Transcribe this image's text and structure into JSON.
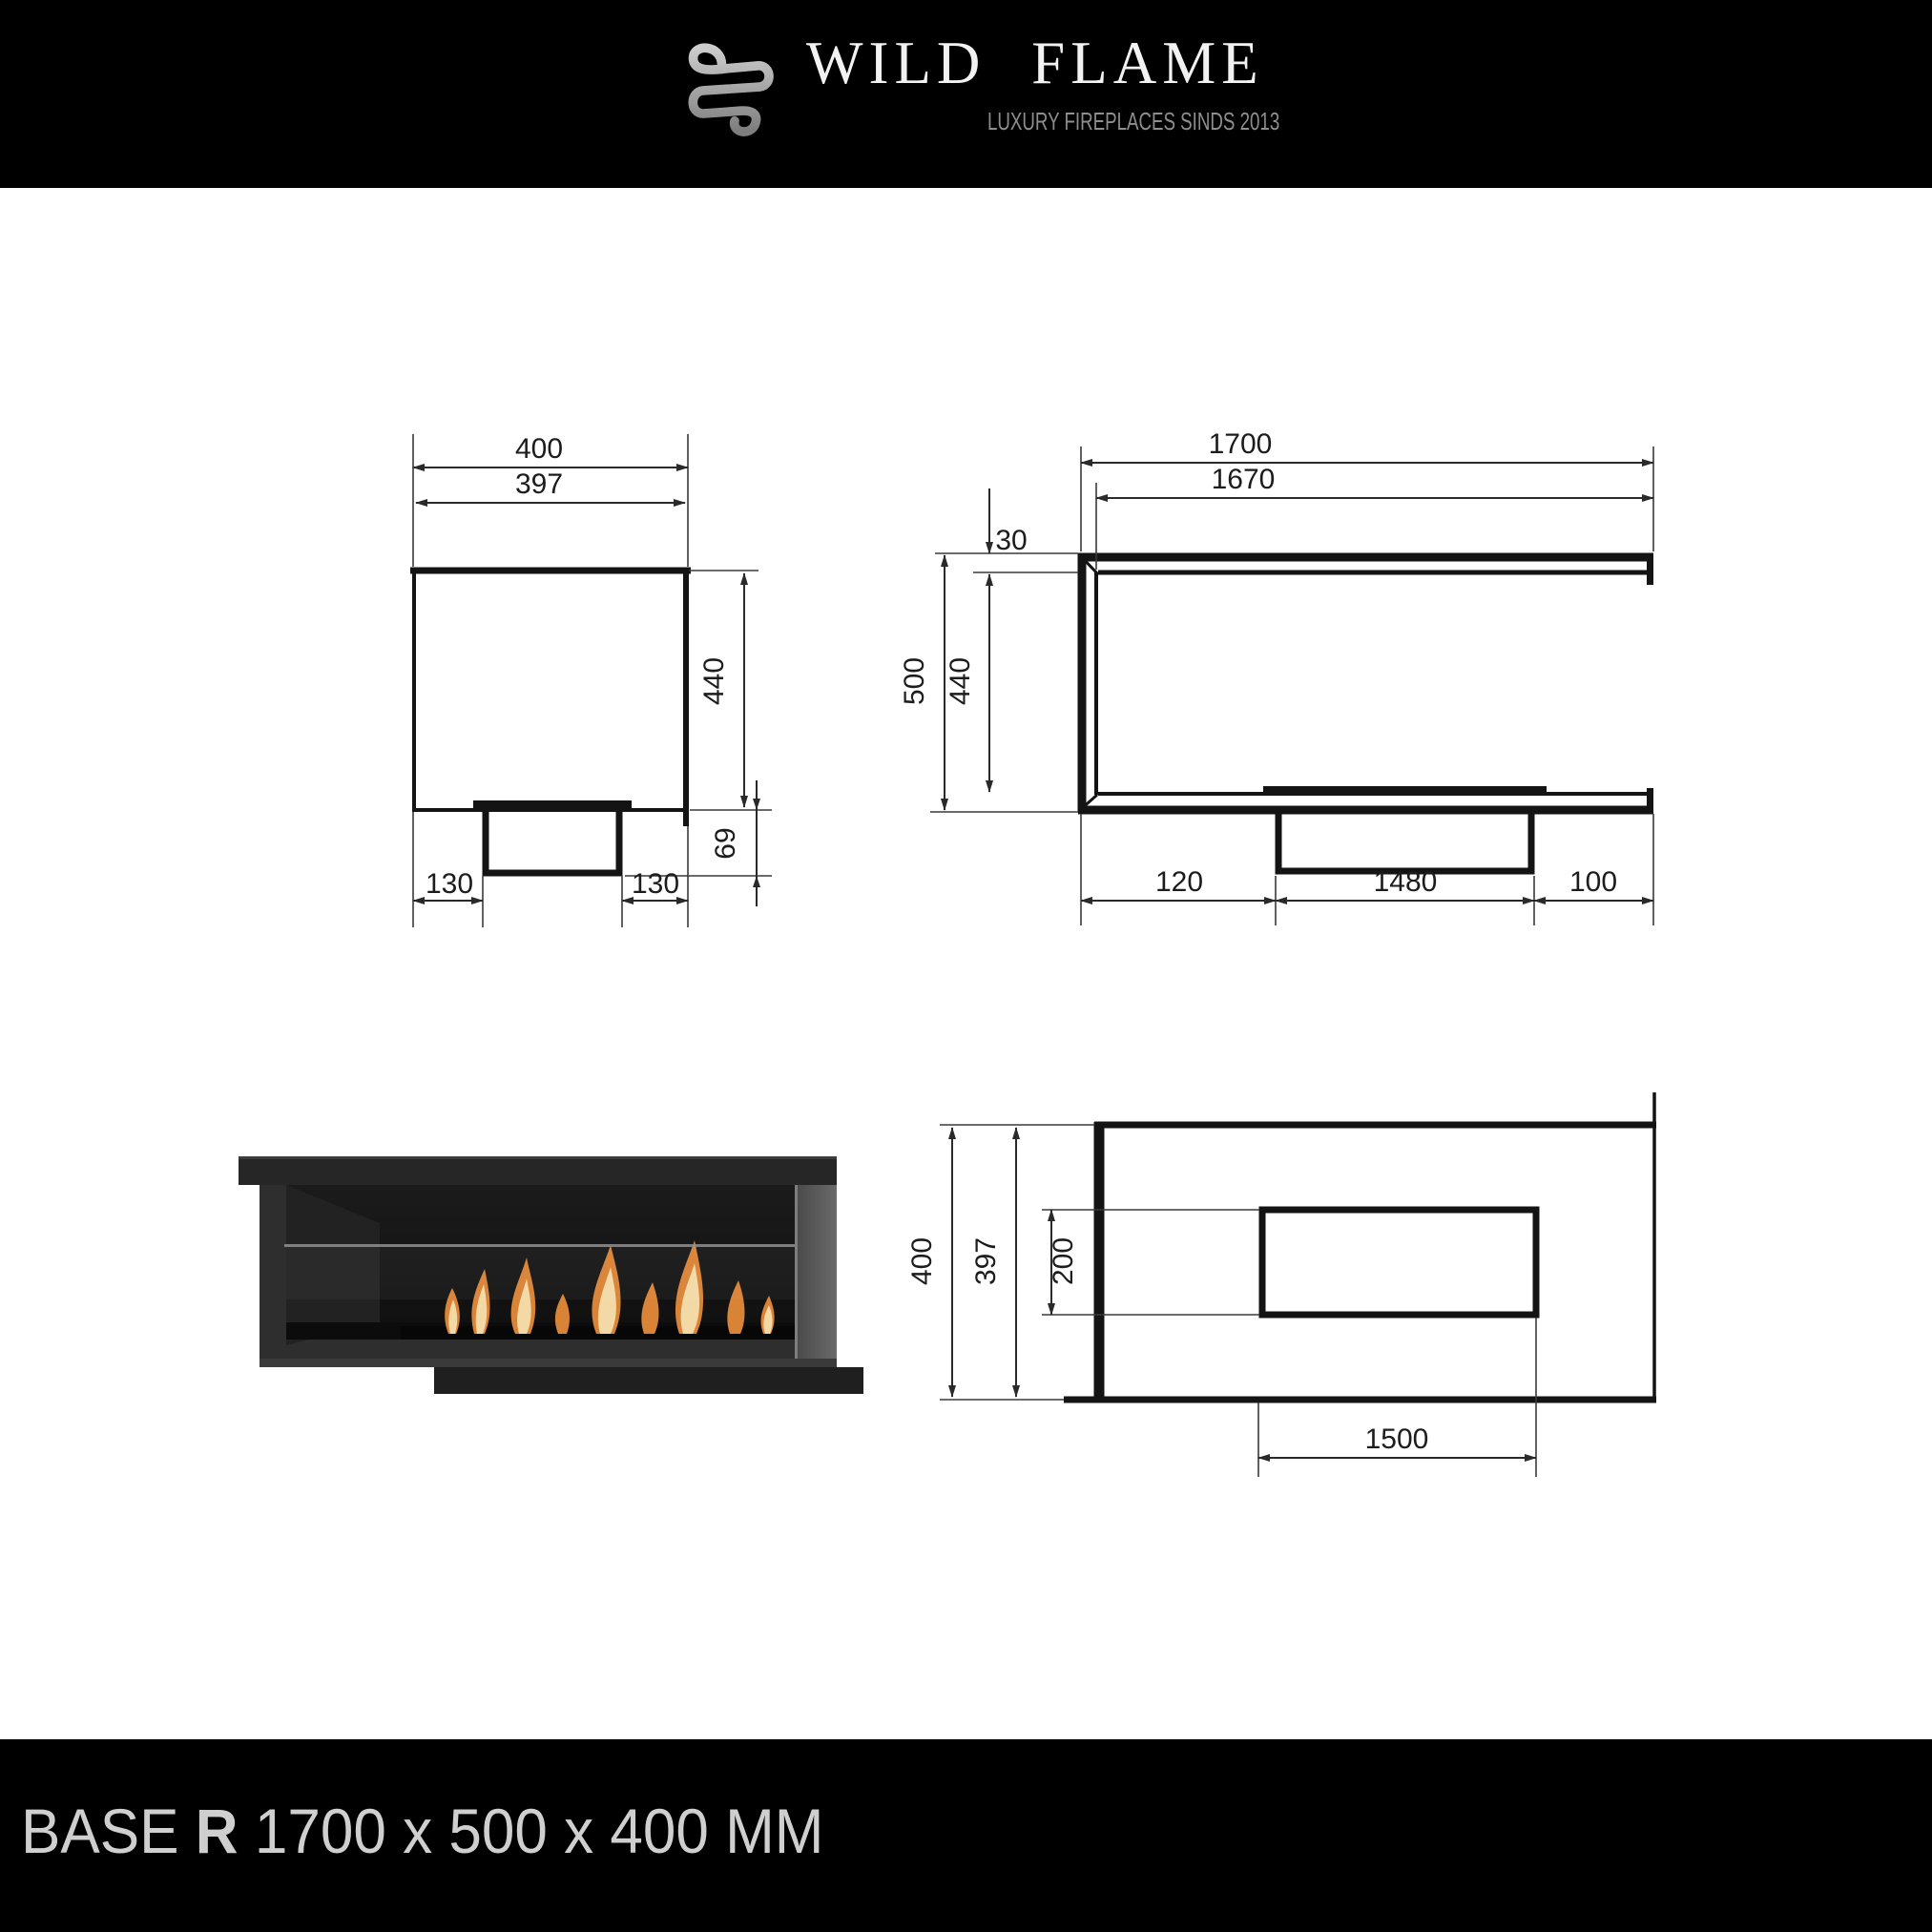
{
  "header": {
    "brand": "WILD  FLAME",
    "tagline": "LUXURY FIREPLACES SINDS 2013",
    "logo_icon": "knot-logo",
    "background": "#000000",
    "brand_color": "#f2f2f2",
    "tagline_color": "#8e8e8e"
  },
  "footer": {
    "model_prefix": "BASE",
    "model_variant": "R",
    "dimensions_text": " 1700 x 500 x 400 MM",
    "background": "#000000",
    "text_color": "#cfcfcf"
  },
  "drawings": {
    "side_view": {
      "title": "side-section-view",
      "dims": {
        "width_outer": "400",
        "width_inner": "397",
        "height_inner": "440",
        "pedestal_height": "69",
        "inset_left": "130",
        "inset_right": "130"
      }
    },
    "front_view": {
      "title": "front-view",
      "dims": {
        "width_total": "1700",
        "width_inner": "1670",
        "top_thickness": "30",
        "height_total": "500",
        "height_inner": "440",
        "burner_offset_left": "120",
        "burner_length": "1480",
        "burner_offset_right": "100"
      }
    },
    "top_view": {
      "title": "top-view",
      "dims": {
        "depth_outer": "400",
        "depth_inner": "397",
        "burner_depth": "200",
        "burner_length": "1500"
      }
    }
  },
  "photo": {
    "label": "fireplace-product-photo",
    "flame_colors": [
      "#d98336",
      "#f3d9a6"
    ],
    "body_color": "#2e2e2e"
  },
  "line_color": "#141414"
}
